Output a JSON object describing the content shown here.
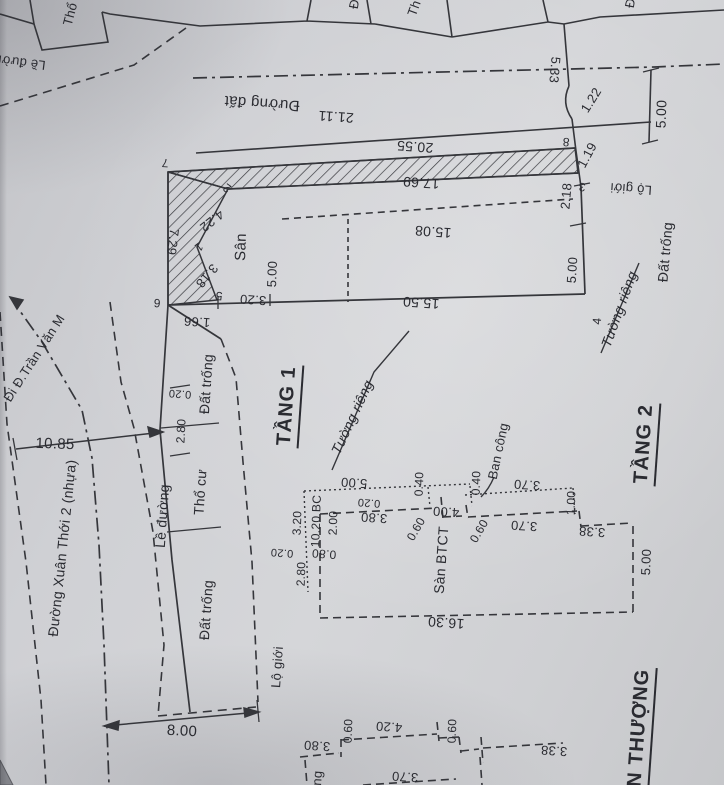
{
  "document": {
    "type": "cadastral-survey-sketch",
    "floors_shown": [
      "TẦNG 1",
      "TẦNG 2"
    ],
    "ink_color": "#35363b",
    "paper_color": "#cfd0d4"
  },
  "labels": {
    "neighbor_tho": "Thổ",
    "neighbor_th": "Th",
    "neighbor_d1": "Đ",
    "neighbor_d2": "Đ",
    "le_duong_top": "Lề đường",
    "duong_dat": "Đường đất",
    "dim_21_11": "21.11",
    "dim_20_55": "20.55",
    "dim_17_69": "17.69",
    "dim_15_08": "15.08",
    "dim_15_50": "15.50",
    "dim_5_33": "5.33",
    "dim_1_22": "1.22",
    "dim_1_19": "1.19",
    "dim_2_18": "2.18",
    "dim_5_00_road": "5.00",
    "lo_gioi_top": "Lộ giới",
    "dat_trong_right": "Đất trống",
    "vertex_8": "8",
    "vertex_3": "3",
    "vertex_7": "7",
    "vertex_2": "2",
    "vertex_1": "1",
    "vertex_5": "5",
    "vertex_6": "6",
    "vertex_4": "4",
    "dim_4_22": "4.22",
    "dim_3_18": "3.18",
    "dim_3_20": "3.20",
    "dim_7_29": "7.29",
    "dim_1_66": "1.66",
    "san": "Sân",
    "dim_5_00_san": "5.00",
    "dim_5_00_right": "5.00",
    "tuong_rieng_right": "Tường riêng",
    "tuong_rieng_left": "Tường riêng",
    "dat_trong_nw": "Đất trống",
    "tho_cu": "Thổ cư",
    "le_duong_left": "Lề đường",
    "street_name": "Đường Xuân Thới 2 (nhựa)",
    "dim_10_85": "10.85",
    "direction_note": "Đi Đ.Trần Văn M",
    "dim_0_20_front": "0.20",
    "dim_2_80_front": "2.80",
    "tang_1": "TẦNG 1",
    "tang_2": "TẦNG 2",
    "dim_5_00_bc": "5.00",
    "dim_0_20_bc": "0.20",
    "dim_3_80_bc": "3.80",
    "dim_0_40_a": "0.40",
    "dim_0_40_b": "0.40",
    "dim_0_60_a": "0.60",
    "dim_0_60_b": "0.60",
    "dim_4_00": "4.00",
    "dim_3_70_a": "3.70",
    "dim_3_70_b": "3.70",
    "dim_1_00": "1.00",
    "ban_cong": "Ban công",
    "san_btct": "Sàn BTCT",
    "dim_3_20_left": "3.20",
    "dim_10_20_bc": "10.20 BC",
    "dim_2_00": "2.00",
    "dim_0_80": "0.80",
    "dim_0_20_left": "0.20",
    "dim_2_80_left": "2.80",
    "dim_16_30": "16.30",
    "dim_5_00_t2": "5.00",
    "dim_3_38_t2": "3.38",
    "dim_8_00": "8.00",
    "lo_gioi_sw": "Lộ giới",
    "dat_trong_sw": "Đất trống",
    "san_thuong": "N THƯỢNG",
    "dim_3_80_bottom": "3.80",
    "dim_0_60_c": "0.60",
    "dim_4_20": "4.20",
    "dim_0_60_d": "0.60",
    "dim_3_38_bottom": "3.38",
    "dim_3_70_bottom": "3.70",
    "fragment_ng": "ng"
  }
}
